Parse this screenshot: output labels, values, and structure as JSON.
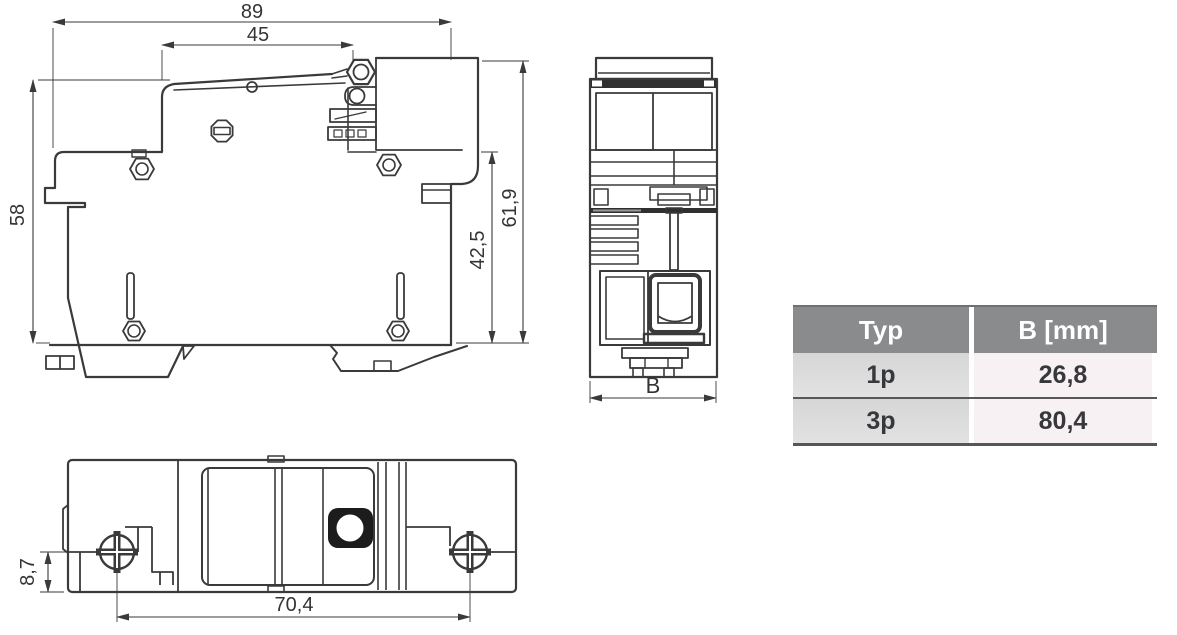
{
  "drawing": {
    "line_color": "#3a3a3a",
    "side": {
      "dim_total_width": "89",
      "dim_upper_width": "45",
      "dim_height": "58",
      "dim_height_full": "61,9",
      "dim_height_lower": "42,5"
    },
    "front": {
      "dim_width_label": "B"
    },
    "bottom": {
      "dim_edge_offset": "8,7",
      "dim_screw_spacing": "70,4"
    }
  },
  "table": {
    "header": {
      "type_label": "Typ",
      "b_label": "B [mm]"
    },
    "rows": [
      {
        "typ": "1p",
        "b": "26,8"
      },
      {
        "typ": "3p",
        "b": "80,4"
      }
    ],
    "colors": {
      "header_bg": "#8a8b8d",
      "header_text": "#ffffff",
      "row_left_bg": "#dcdcdd",
      "row_right_bg": "#f8f1f4",
      "divider": "#58585a"
    }
  },
  "chart_data": {
    "type": "table",
    "title": "",
    "columns": [
      "Typ",
      "B [mm]"
    ],
    "rows": [
      [
        "1p",
        "26,8"
      ],
      [
        "3p",
        "80,4"
      ]
    ]
  }
}
